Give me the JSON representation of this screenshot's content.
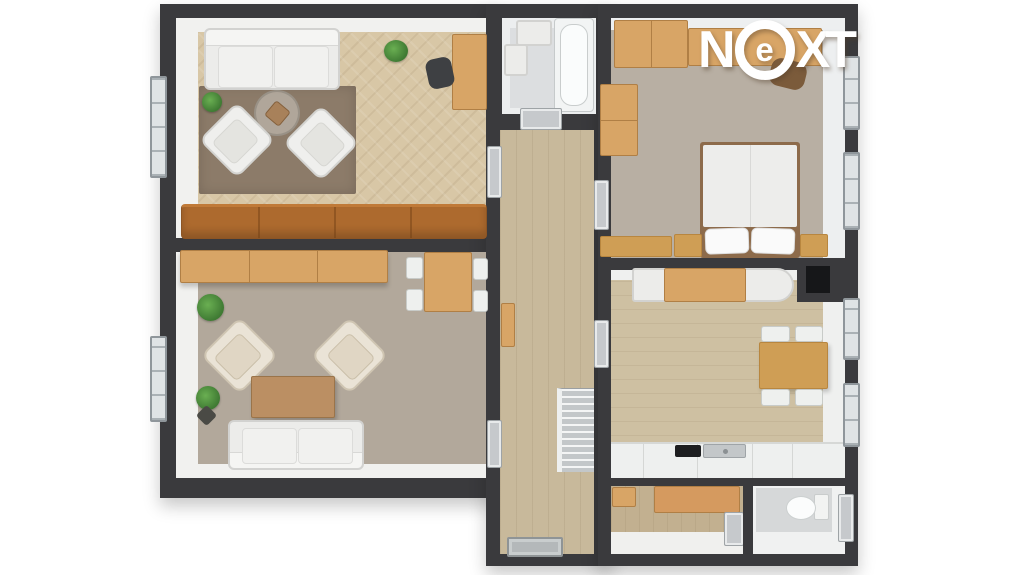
{
  "logo": {
    "letters": [
      "N",
      "e",
      "X",
      "T"
    ],
    "circled_letter": "e",
    "color": "#ffffff"
  },
  "palette": {
    "wall": "#3a3a3d",
    "background": "#ffffff",
    "living_room_floor": "#d8c7a6",
    "lounge_floor": "#b2a89b",
    "bedroom_floor": "#b8afa3",
    "kitchen_floor": "#cec0a2",
    "hallway_floor": "#c8b99b",
    "bathroom_floor": "#dcdee0",
    "wc_floor": "#d6d8d9",
    "wood_furniture": "#d8a566",
    "leather_sofa": "#ad6a2e",
    "white_furniture": "#ececea",
    "rug": "#8c7b69",
    "plant": "#4c8b3f",
    "stairs": "#c3c7c9"
  },
  "floorplan": {
    "type": "apartment-3d-top-view",
    "rooms": [
      {
        "name": "living-room",
        "position": "top-left",
        "furniture": [
          "white-sofa",
          "rug",
          "round-coffee-table",
          "two-armchairs",
          "desk-with-office-chair",
          "plants",
          "brown-leather-sectional-sofa",
          "window"
        ]
      },
      {
        "name": "lounge-office",
        "position": "bottom-left",
        "furniture": [
          "wood-wardrobe-row",
          "work-table-with-four-chairs",
          "two-cream-armchairs",
          "wood-coffee-table",
          "white-sofa",
          "plants",
          "window"
        ]
      },
      {
        "name": "bathroom",
        "position": "top-middle",
        "furniture": [
          "bathtub",
          "sink",
          "washer"
        ]
      },
      {
        "name": "hallway",
        "position": "middle",
        "furniture": [
          "staircase",
          "console-shelf",
          "entrance-mat"
        ]
      },
      {
        "name": "bedroom",
        "position": "top-right",
        "furniture": [
          "double-bed-white-bedding",
          "two-nightstands",
          "wardrobe",
          "dresser",
          "wall-shelf",
          "desk-chair",
          "bench",
          "two-windows"
        ]
      },
      {
        "name": "kitchen-dining",
        "position": "bottom-right",
        "furniture": [
          "sideboard",
          "dining-table-four-chairs",
          "kitchen-counter",
          "cooktop",
          "sink",
          "fireplace-black-unit",
          "two-windows"
        ]
      },
      {
        "name": "utility-closet",
        "position": "bottom-right-lower",
        "furniture": [
          "wood-cabinets"
        ]
      },
      {
        "name": "wc",
        "position": "bottom-right-corner",
        "furniture": [
          "toilet",
          "door"
        ]
      }
    ]
  }
}
